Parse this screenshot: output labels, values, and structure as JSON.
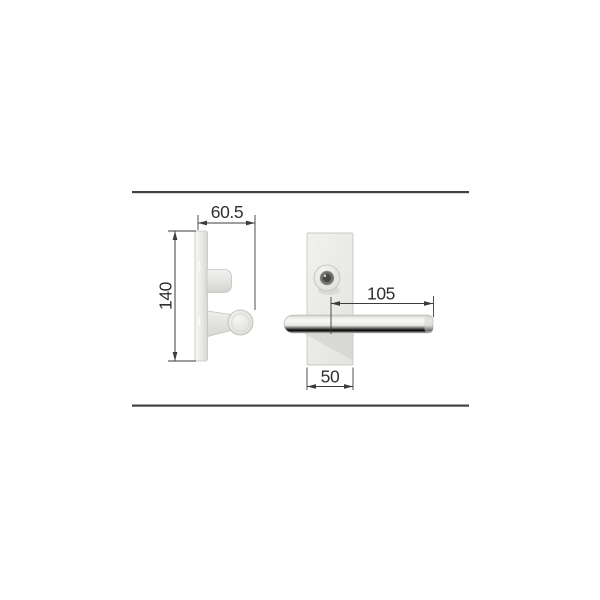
{
  "diagram": {
    "type": "technical-dimension-drawing",
    "subject": "door-lever-handle",
    "dimensions": {
      "projection_depth_label": "60.5",
      "plate_height_label": "140",
      "lever_length_label": "105",
      "plate_width_label": "50"
    },
    "colors": {
      "background": "#ffffff",
      "separator_line": "#414141",
      "dimension_line": "#3c3c3c",
      "metal_light": "#f5f5f3",
      "metal_mid": "#e7e7e4",
      "metal_dark": "#c9c9c6",
      "shadow": "#cfcfcc",
      "screw_dark": "#474745"
    }
  }
}
